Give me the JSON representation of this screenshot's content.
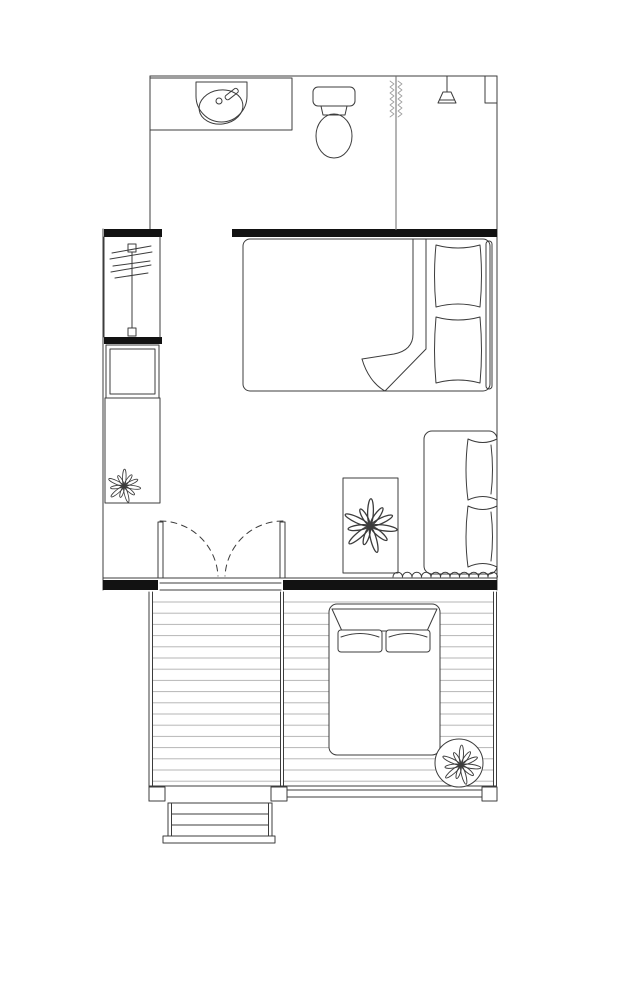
{
  "document": {
    "type": "architectural-floor-plan",
    "orientation": "portrait",
    "text_labels": []
  },
  "colors": {
    "background": "#ffffff",
    "line": "#3c3c3c",
    "wall_fill": "#121212",
    "line_light": "#9c9c9c",
    "board_line": "#b6b6b6",
    "fill_white": "#ffffff"
  },
  "rooms": {
    "bathroom": {
      "position": "top",
      "fixtures": [
        "vanity-counter",
        "oval-sink",
        "faucet",
        "drain",
        "toilet",
        "shower-head",
        "shower-curtain",
        "shower-partition",
        "corner-niche"
      ]
    },
    "closet": {
      "position": "left-column",
      "items": [
        "clothes-rail",
        "clothes-hangers",
        "appliance-box",
        "cabinet",
        "potted-plant"
      ]
    },
    "bedroom": {
      "position": "center-right",
      "furniture": [
        "double-bed",
        "blanket-fold",
        "pillow-top",
        "pillow-bottom",
        "headboard"
      ]
    },
    "living-area": {
      "position": "center",
      "furniture": [
        "sofa",
        "sofa-cushion-top",
        "sofa-cushion-bottom",
        "rug",
        "potted-plant",
        "double-french-door",
        "scalloped-curtain"
      ]
    },
    "deck": {
      "position": "bottom",
      "floor": "wood-decking",
      "furniture": [
        "daybed",
        "daybed-headboard",
        "pillow-left",
        "pillow-right",
        "round-planter",
        "potted-plant",
        "railing",
        "deck-posts",
        "stairs"
      ]
    }
  }
}
